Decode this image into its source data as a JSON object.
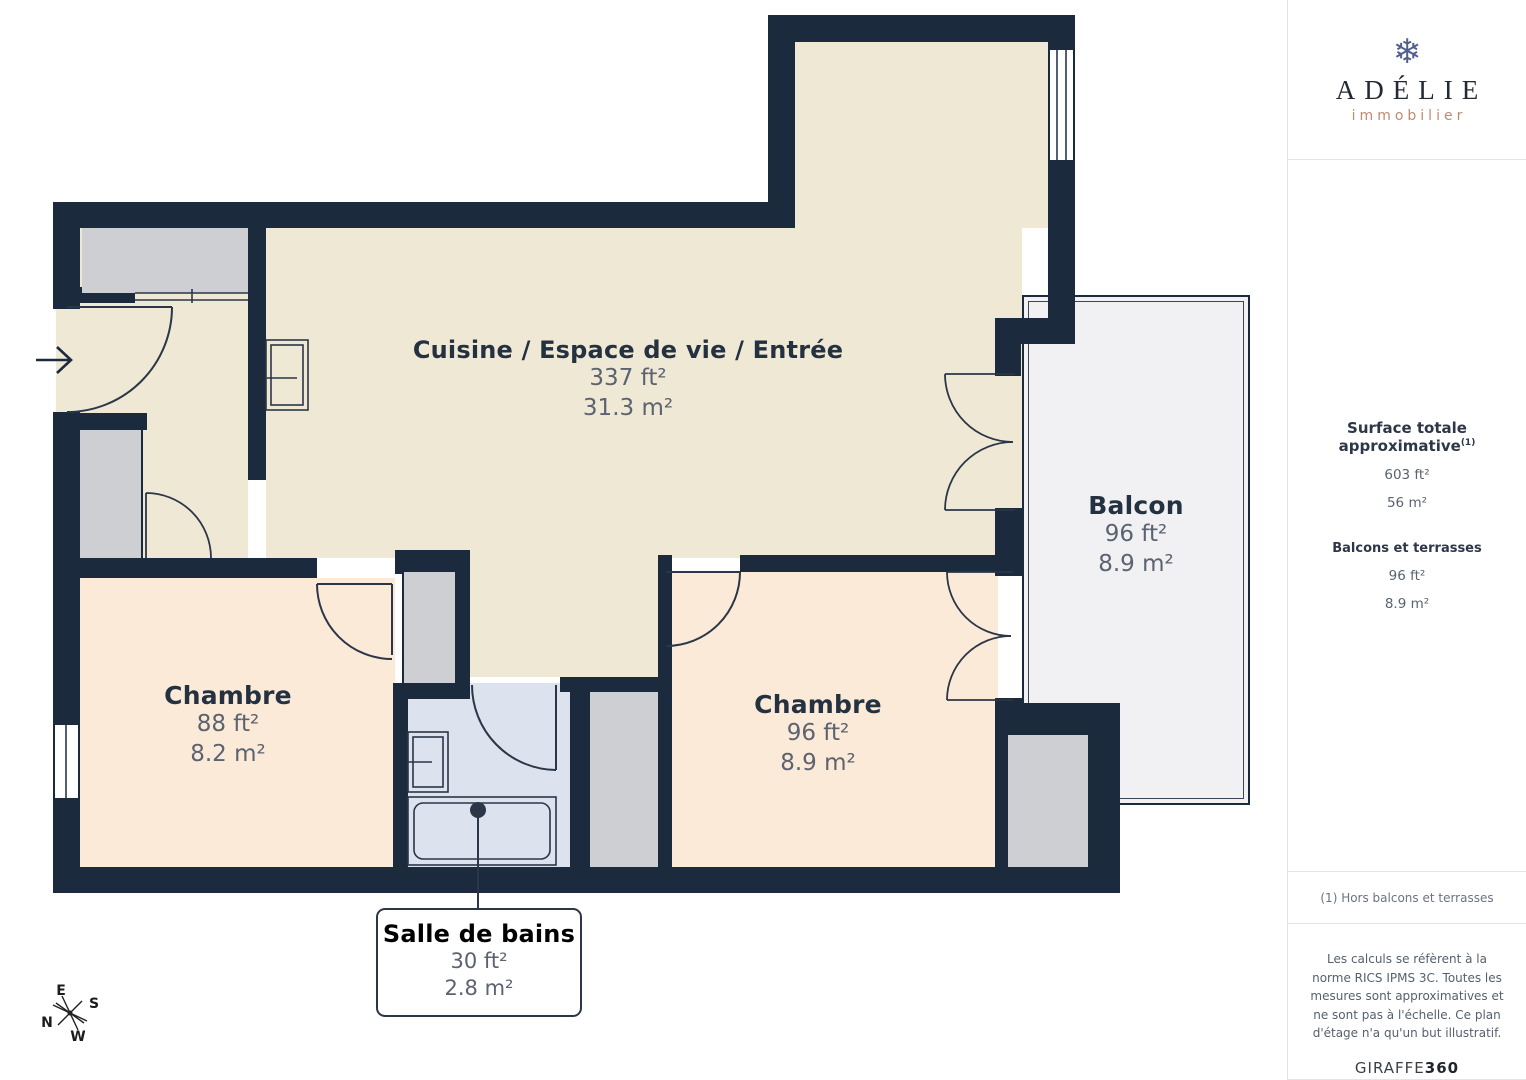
{
  "sidebar": {
    "logo": {
      "icon": "snowflake",
      "brand": "ADÉLIE",
      "tagline": "immobilier"
    },
    "surface": {
      "heading": "Surface totale approximative",
      "footnote_marker": "(1)",
      "total_ft": "603 ft²",
      "total_m": "56 m²",
      "balconies_heading": "Balcons et terrasses",
      "balconies_ft": "96 ft²",
      "balconies_m": "8.9 m²"
    },
    "footnote": "(1) Hors balcons et terrasses",
    "legal": "Les calculs se réfèrent à la norme RICS IPMS 3C. Toutes les mesures sont approximatives et ne sont pas à l'échelle. Ce plan d'étage n'a qu'un but illustratif.",
    "brand_footer": {
      "name": "GIRAFFE",
      "suffix": "360"
    }
  },
  "floorplan": {
    "rooms": [
      {
        "name": "Cuisine / Espace de vie / Entrée",
        "area_ft": "337 ft²",
        "area_m": "31.3 m²"
      },
      {
        "name": "Chambre",
        "area_ft": "88 ft²",
        "area_m": "8.2 m²"
      },
      {
        "name": "Chambre",
        "area_ft": "96 ft²",
        "area_m": "8.9 m²"
      },
      {
        "name": "Balcon",
        "area_ft": "96 ft²",
        "area_m": "8.9 m²"
      },
      {
        "name": "Salle de bains",
        "area_ft": "30 ft²",
        "area_m": "2.8 m²"
      }
    ],
    "compass": {
      "n": "N",
      "s": "S",
      "e": "E",
      "w": "W"
    },
    "colors": {
      "wall": "#1b2a3c",
      "living": "#efe8d5",
      "bedroom": "#fcead9",
      "bathroom": "#dde3ee",
      "closet": "#cdcfd3",
      "balcony": "#f1f1f3",
      "accent": "#bf8a70"
    }
  }
}
